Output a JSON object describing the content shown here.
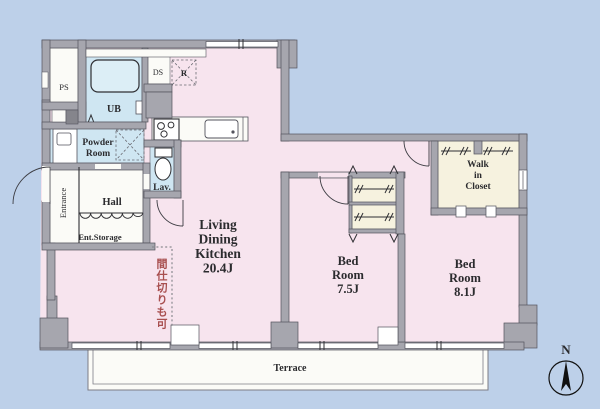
{
  "plan": {
    "ldk": {
      "lines": [
        "Living",
        "Dining",
        "Kitchen"
      ],
      "size": "20.4J"
    },
    "bedroom_a": {
      "lines": [
        "Bed",
        "Room"
      ],
      "size": "7.5J"
    },
    "bedroom_b": {
      "lines": [
        "Bed",
        "Room"
      ],
      "size": "8.1J"
    },
    "walk_in_closet": {
      "lines": [
        "Walk",
        "in",
        "Closet"
      ]
    },
    "powder_room": {
      "lines": [
        "Powder",
        "Room"
      ]
    },
    "hall": "Hall",
    "entrance": "Entrance",
    "entrance_storage": "Ent.Storage",
    "lavatory": "Lav.",
    "unit_bath": "UB",
    "pipe_space": "PS",
    "duct_space": "DS",
    "refrigerator": "R",
    "terrace": "Terrace",
    "partition_note": "間仕切りも可",
    "compass_north": "N"
  },
  "colors": {
    "background": "#bdd0e9",
    "room_pink": "#f7e4ee",
    "wet_area_blue": "#cfe6f2",
    "closet_cream": "#f6f2df",
    "white_room": "#fbfbf7",
    "wall_gray": "#a6a6ae",
    "wall_edge": "#53535c",
    "note_red": "#a84f4f"
  }
}
